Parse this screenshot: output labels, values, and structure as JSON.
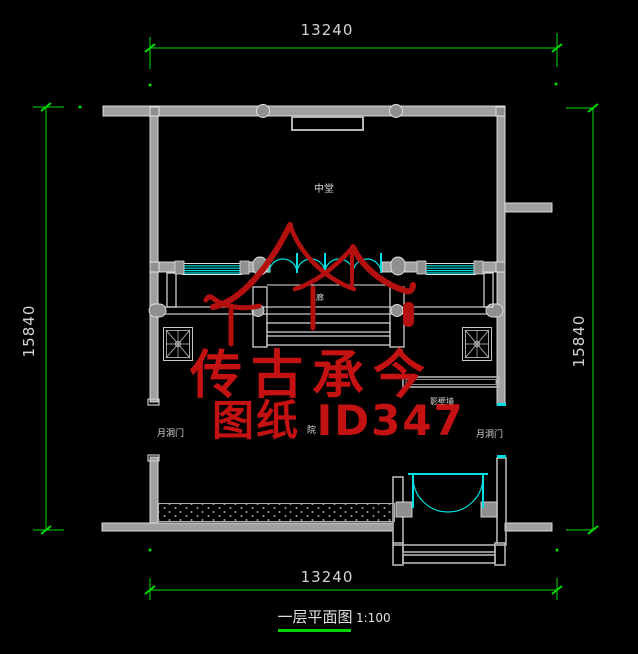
{
  "dimensions": {
    "top": "13240",
    "bottom": "13240",
    "left": "15840",
    "right": "15840"
  },
  "room_labels": {
    "middle_hall": "中堂",
    "corridor": "廊",
    "courtyard": "院",
    "moon_gate_left": "月洞门",
    "moon_gate_right": "月洞门",
    "screen_wall": "影壁墙"
  },
  "watermark": {
    "brand": "传古承今",
    "sheet_id": "图纸 ID347"
  },
  "title_block": {
    "title": "一层平面图",
    "scale": "1:100"
  },
  "colors": {
    "background": "#000000",
    "walls": "#a8a8a8",
    "wall_edge": "#e6e6e6",
    "dimension_green": "#00dd00",
    "glazing_cyan": "#00e0e0",
    "watermark_red": "#c41111",
    "label_white": "#d9d9d9"
  }
}
